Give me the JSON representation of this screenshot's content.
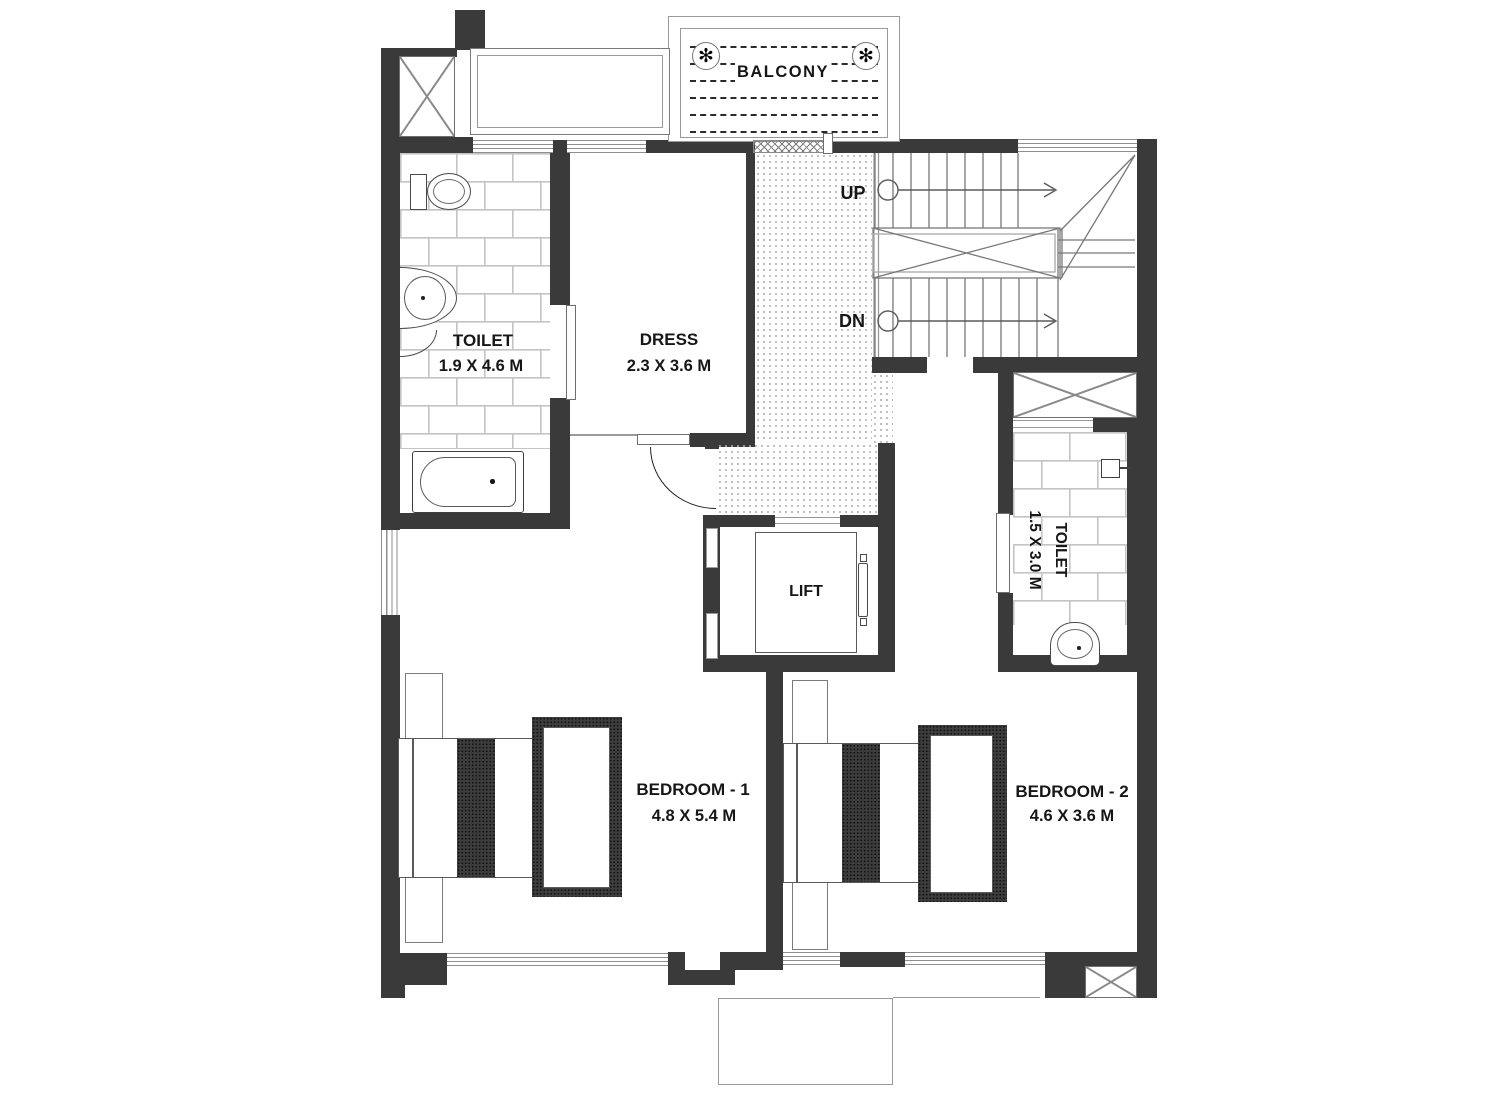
{
  "plan_title": "Floor plan",
  "balcony": {
    "label": "BALCONY",
    "medallion_glyph": "✻"
  },
  "toilet1": {
    "label": "TOILET",
    "dims": "1.9 X 4.6 M"
  },
  "dress": {
    "label": "DRESS",
    "dims": "2.3 X 3.6 M"
  },
  "stairs": {
    "up_label": "UP",
    "dn_label": "DN"
  },
  "lift": {
    "label": "LIFT"
  },
  "toilet2": {
    "label": "TOILET",
    "dims": "1.5 X 3.0 M"
  },
  "bedroom1": {
    "label": "BEDROOM - 1",
    "dims": "4.8 X 5.4 M"
  },
  "bedroom2": {
    "label": "BEDROOM - 2",
    "dims": "4.6 X 3.6 M"
  },
  "colors": {
    "wall": "#3a3a3a",
    "thin_line": "#8a8a8a",
    "tile_line": "#c4c4c4",
    "text": "#161616"
  }
}
